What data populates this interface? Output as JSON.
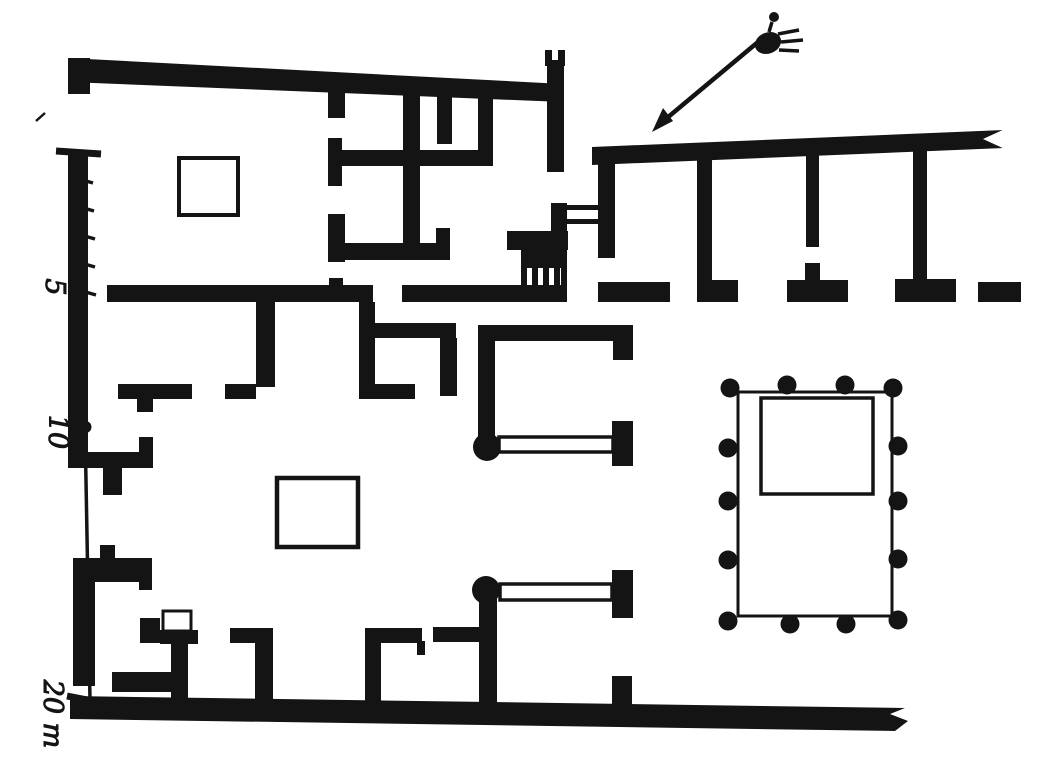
{
  "figure": {
    "kind": "engraved floor plan of a Roman atrium house with street portico and colonnaded peristyle"
  },
  "colors": {
    "ink": "#141414",
    "paper": "#ffffff"
  },
  "scale_bar": {
    "unit": "m",
    "tick_labels": [
      "5",
      "10",
      "20 m"
    ],
    "minor_ticks_first_span": 5
  },
  "north_indicator": {
    "symbol": "sketched ornament with arrow pointing to the entrance wall"
  },
  "peristyle": {
    "column_count": 14,
    "columns_top_row": 4,
    "columns_bottom_row": 4,
    "columns_left_side": 4,
    "columns_right_side": 4
  },
  "basins": {
    "impluvium_count": 2,
    "peristyle_pool_count": 1,
    "hearth_count": 1
  }
}
